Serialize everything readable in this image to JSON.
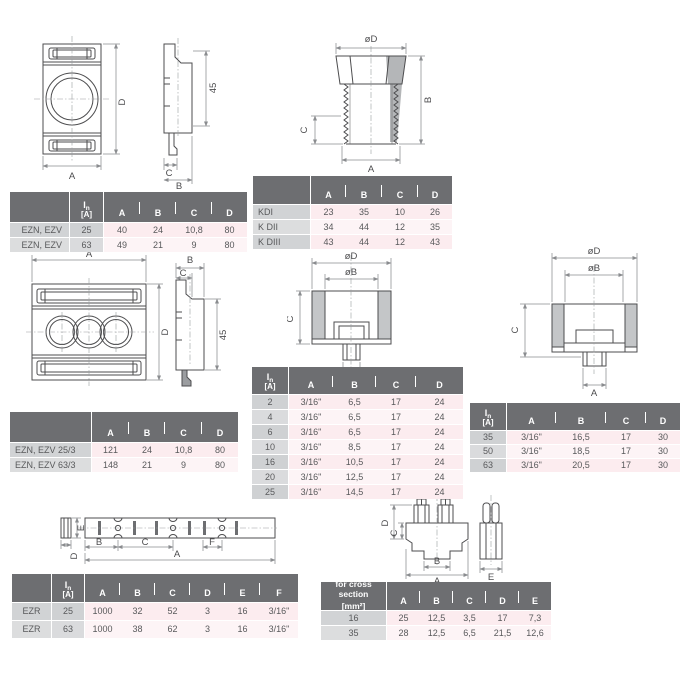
{
  "page": {
    "type": "technical datasheet dimension page",
    "background": "#ffffff"
  },
  "colors": {
    "header_bg": "#6d6e71",
    "header_text": "#ffffff",
    "label_col_bg": "#d1d3d5",
    "label_col_bg_alt": "#dcddde",
    "data_cell_bg": "#fcecef",
    "data_cell_bg_alt": "#fdf4f6",
    "cell_text": "#58595b",
    "line_color": "#4d4d4f"
  },
  "drawings": {
    "ezn_single": {
      "labels": {
        "A": "A",
        "B": "B",
        "C": "C",
        "D": "D",
        "d45": "45"
      }
    },
    "kd_gland": {
      "labels": {
        "oD": "øD",
        "A": "A",
        "B": "B",
        "C": "C"
      }
    },
    "ezn_triple": {
      "labels": {
        "A": "A",
        "B": "B",
        "C": "C",
        "D": "D",
        "d45": "45"
      }
    },
    "clamp_small": {
      "labels": {
        "oD": "øD",
        "oB": "øB",
        "C": "C",
        "A": "A"
      }
    },
    "clamp_large": {
      "labels": {
        "oD": "øD",
        "oB": "øB",
        "C": "C",
        "A": "A"
      }
    },
    "ezr_busbar": {
      "labels": {
        "E": "E",
        "D": "D",
        "B": "B",
        "C": "C",
        "F": "F",
        "A": "A"
      }
    },
    "terminal": {
      "labels": {
        "D": "D",
        "C": "C",
        "B": "B",
        "A": "A",
        "E": "E"
      }
    }
  },
  "tables": [
    {
      "id": "ezn1",
      "name_col": true,
      "in_col": true,
      "label_header_lines": [],
      "in_header": {
        "symbol": "I",
        "sub": "n",
        "unit": "[A]"
      },
      "columns": [
        "A",
        "B",
        "C",
        "D"
      ],
      "rows": [
        {
          "label": "EZN, EZV",
          "in": "25",
          "values": [
            "40",
            "24",
            "10,8",
            "80"
          ]
        },
        {
          "label": "EZN, EZV",
          "in": "63",
          "values": [
            "49",
            "21",
            "9",
            "80"
          ]
        }
      ]
    },
    {
      "id": "kd",
      "name_col": true,
      "in_col": false,
      "label_header_lines": [],
      "columns": [
        "A",
        "B",
        "C",
        "D"
      ],
      "rows": [
        {
          "label": "KDI",
          "values": [
            "23",
            "35",
            "10",
            "26"
          ]
        },
        {
          "label": "K DII",
          "values": [
            "34",
            "44",
            "12",
            "35"
          ]
        },
        {
          "label": "K DIII",
          "values": [
            "43",
            "44",
            "12",
            "43"
          ]
        }
      ]
    },
    {
      "id": "ezn3",
      "name_col": true,
      "in_col": false,
      "label_header_lines": [],
      "columns": [
        "A",
        "B",
        "C",
        "D"
      ],
      "rows": [
        {
          "label": "EZN, EZV 25/3",
          "values": [
            "121",
            "24",
            "10,8",
            "80"
          ]
        },
        {
          "label": "EZN, EZV 63/3",
          "values": [
            "148",
            "21",
            "9",
            "80"
          ]
        }
      ]
    },
    {
      "id": "clampA",
      "name_col": false,
      "in_col": true,
      "in_header": {
        "symbol": "I",
        "sub": "n",
        "unit": "[A]"
      },
      "columns": [
        "A",
        "B",
        "C",
        "D"
      ],
      "rows": [
        {
          "in": "2",
          "values": [
            "3/16\"",
            "6,5",
            "17",
            "24"
          ]
        },
        {
          "in": "4",
          "values": [
            "3/16\"",
            "6,5",
            "17",
            "24"
          ]
        },
        {
          "in": "6",
          "values": [
            "3/16\"",
            "6,5",
            "17",
            "24"
          ]
        },
        {
          "in": "10",
          "values": [
            "3/16\"",
            "8,5",
            "17",
            "24"
          ]
        },
        {
          "in": "16",
          "values": [
            "3/16\"",
            "10,5",
            "17",
            "24"
          ]
        },
        {
          "in": "20",
          "values": [
            "3/16\"",
            "12,5",
            "17",
            "24"
          ]
        },
        {
          "in": "25",
          "values": [
            "3/16\"",
            "14,5",
            "17",
            "24"
          ]
        }
      ]
    },
    {
      "id": "clampB",
      "name_col": false,
      "in_col": true,
      "in_header": {
        "symbol": "I",
        "sub": "n",
        "unit": "[A]"
      },
      "columns": [
        "A",
        "B",
        "C",
        "D"
      ],
      "rows": [
        {
          "in": "35",
          "values": [
            "3/16\"",
            "16,5",
            "17",
            "30"
          ]
        },
        {
          "in": "50",
          "values": [
            "3/16\"",
            "18,5",
            "17",
            "30"
          ]
        },
        {
          "in": "63",
          "values": [
            "3/16\"",
            "20,5",
            "17",
            "30"
          ]
        }
      ]
    },
    {
      "id": "ezr",
      "name_col": true,
      "in_col": true,
      "label_header_lines": [],
      "in_header": {
        "symbol": "I",
        "sub": "n",
        "unit": "[A]"
      },
      "columns": [
        "A",
        "B",
        "C",
        "D",
        "E",
        "F"
      ],
      "rows": [
        {
          "label": "EZR",
          "in": "25",
          "values": [
            "1000",
            "32",
            "52",
            "3",
            "16",
            "3/16\""
          ]
        },
        {
          "label": "EZR",
          "in": "63",
          "values": [
            "1000",
            "38",
            "62",
            "3",
            "16",
            "3/16\""
          ]
        }
      ]
    },
    {
      "id": "cross",
      "name_col": true,
      "in_col": false,
      "label_header_lines": [
        "for cross section",
        "[mm²]"
      ],
      "columns": [
        "A",
        "B",
        "C",
        "D",
        "E"
      ],
      "rows": [
        {
          "label": "16",
          "values": [
            "25",
            "12,5",
            "3,5",
            "17",
            "7,3"
          ]
        },
        {
          "label": "35",
          "values": [
            "28",
            "12,5",
            "6,5",
            "21,5",
            "12,6"
          ]
        }
      ]
    }
  ]
}
